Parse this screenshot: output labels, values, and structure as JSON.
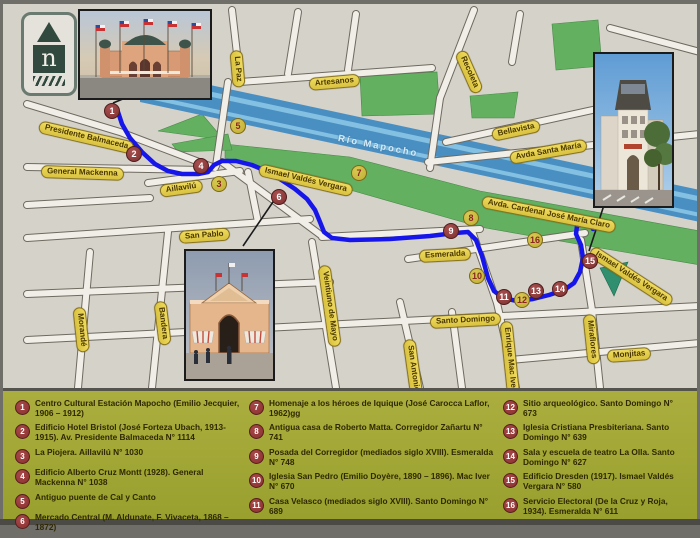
{
  "north_badge": {
    "letter": "n"
  },
  "map": {
    "river_label": "Río Mapocho",
    "street_labels": [
      {
        "text": "Presidente Balmaceda",
        "x": 36,
        "y": 116,
        "rot": 13
      },
      {
        "text": "General Mackenna",
        "x": 38,
        "y": 161,
        "rot": 2
      },
      {
        "text": "Aillavilú",
        "x": 157,
        "y": 181,
        "rot": -8
      },
      {
        "text": "La Paz",
        "x": 233,
        "y": 40,
        "rot": 85
      },
      {
        "text": "Artesanos",
        "x": 306,
        "y": 74,
        "rot": -5
      },
      {
        "text": "Recoleta",
        "x": 457,
        "y": 41,
        "rot": 66
      },
      {
        "text": "Ismael Valdés Vergara",
        "x": 256,
        "y": 159,
        "rot": 13
      },
      {
        "text": "Bellavista",
        "x": 489,
        "y": 125,
        "rot": -12
      },
      {
        "text": "Avda  Santa María",
        "x": 507,
        "y": 148,
        "rot": -10
      },
      {
        "text": "Avda. Cardenal José María Claro",
        "x": 479,
        "y": 191,
        "rot": 11
      },
      {
        "text": "San Pablo",
        "x": 176,
        "y": 227,
        "rot": -4
      },
      {
        "text": "Bandera",
        "x": 157,
        "y": 291,
        "rot": 83
      },
      {
        "text": "Morandé",
        "x": 76,
        "y": 297,
        "rot": 84
      },
      {
        "text": "Veintiuno de Mayo",
        "x": 321,
        "y": 255,
        "rot": 82
      },
      {
        "text": "San Antonio",
        "x": 406,
        "y": 329,
        "rot": 82
      },
      {
        "text": "Esmeralda",
        "x": 416,
        "y": 246,
        "rot": -3
      },
      {
        "text": "Santo Domingo",
        "x": 427,
        "y": 312,
        "rot": -3
      },
      {
        "text": "Enrique Mac Iver",
        "x": 503,
        "y": 311,
        "rot": 84
      },
      {
        "text": "Miraflores",
        "x": 586,
        "y": 304,
        "rot": 84
      },
      {
        "text": "Monjitas",
        "x": 604,
        "y": 346,
        "rot": -4
      },
      {
        "text": "Ismael Valdés Vergara",
        "x": 588,
        "y": 240,
        "rot": 33
      }
    ],
    "markers": [
      {
        "n": "1",
        "x": 109,
        "y": 107,
        "type": "red"
      },
      {
        "n": "2",
        "x": 131,
        "y": 150,
        "type": "red"
      },
      {
        "n": "3",
        "x": 216,
        "y": 180,
        "type": "yellow"
      },
      {
        "n": "4",
        "x": 198,
        "y": 162,
        "type": "red"
      },
      {
        "n": "5",
        "x": 235,
        "y": 122,
        "type": "yellow"
      },
      {
        "n": "6",
        "x": 276,
        "y": 193,
        "type": "red"
      },
      {
        "n": "7",
        "x": 356,
        "y": 169,
        "type": "yellow"
      },
      {
        "n": "8",
        "x": 468,
        "y": 214,
        "type": "yellow"
      },
      {
        "n": "9",
        "x": 448,
        "y": 227,
        "type": "red"
      },
      {
        "n": "10",
        "x": 474,
        "y": 272,
        "type": "yellow"
      },
      {
        "n": "11",
        "x": 501,
        "y": 293,
        "type": "red"
      },
      {
        "n": "12",
        "x": 519,
        "y": 296,
        "type": "yellow"
      },
      {
        "n": "13",
        "x": 533,
        "y": 287,
        "type": "red"
      },
      {
        "n": "14",
        "x": 557,
        "y": 285,
        "type": "red"
      },
      {
        "n": "15",
        "x": 587,
        "y": 257,
        "type": "red"
      },
      {
        "n": "16",
        "x": 532,
        "y": 236,
        "type": "yellow"
      }
    ],
    "route_points": "118,112 122,124 130,138 142,152 155,164 168,171 182,174 198,174 208,172 214,165 222,161 236,161 252,165 266,171 280,179 295,189 307,199 315,210 320,222 324,232 332,238 350,240 390,239 430,236 455,233 468,232 476,240 482,256 488,278 494,291 503,298 517,301 533,299 549,295 564,290 574,283 580,272 583,258 581,245 576,234 577,226 584,221 591,223 593,229",
    "leader_lines": [
      [
        140,
        92,
        113,
        103
      ],
      [
        275,
        199,
        243,
        246
      ],
      [
        606,
        199,
        589,
        251
      ]
    ],
    "colors": {
      "route": "#1616ea",
      "river": "#4a8fc2",
      "park": "#62b060",
      "dark_park": "#2f8f6e",
      "pill_fill": "#e6cf4e",
      "marker_red": "#8a3434",
      "marker_yellow": "#c9b93e",
      "legend_bg": "#a2a636"
    }
  },
  "photos": [
    {
      "id": "estacion-mapocho-photo"
    },
    {
      "id": "edificio-dresden-photo"
    },
    {
      "id": "mercado-central-photo"
    }
  ],
  "legend": {
    "columns": [
      [
        {
          "n": "1",
          "text": "Centro Cultural Estación Mapocho (Emilio Jecquier, 1906 – 1912)"
        },
        {
          "n": "2",
          "text": "Edificio Hotel Bristol (José Forteza Ubach, 1913- 1915). Av. Presidente Balmaceda N° 1114"
        },
        {
          "n": "3",
          "text": "La Piojera. Aillavilú N° 1030"
        },
        {
          "n": "4",
          "text": "Edificio Alberto Cruz Montt (1928). General Mackenna N° 1038"
        },
        {
          "n": "5",
          "text": "Antiguo puente de Cal y Canto"
        },
        {
          "n": "6",
          "text": "Mercado Central (M. Aldunate, F. Vivaceta, 1868 – 1872)"
        }
      ],
      [
        {
          "n": "7",
          "text": "Homenaje a los héroes de Iquique (José Carocca Laflor, 1962)gg"
        },
        {
          "n": "8",
          "text": "Antigua casa de Roberto Matta. Corregidor Zañartu N° 741"
        },
        {
          "n": "9",
          "text": "Posada del Corregidor (mediados siglo XVIII). Esmeralda N° 748"
        },
        {
          "n": "10",
          "text": "Iglesia San Pedro (Emilio Doyère, 1890 – 1896). Mac Iver N° 670"
        },
        {
          "n": "11",
          "text": "Casa Velasco (mediados siglo XVIII). Santo Domingo N° 689"
        }
      ],
      [
        {
          "n": "12",
          "text": "Sitio arqueológico. Santo Domingo N° 673"
        },
        {
          "n": "13",
          "text": "Iglesia Cristiana Presbiteriana. Santo Domingo N° 639"
        },
        {
          "n": "14",
          "text": "Sala y escuela de teatro La Olla. Santo Domingo N° 627"
        },
        {
          "n": "15",
          "text": "Edificio Dresden (1917). Ismael Valdés Vergara N° 580"
        },
        {
          "n": "16",
          "text": "Servicio Electoral (De la Cruz y Roja, 1934). Esmeralda N° 611"
        }
      ]
    ]
  }
}
